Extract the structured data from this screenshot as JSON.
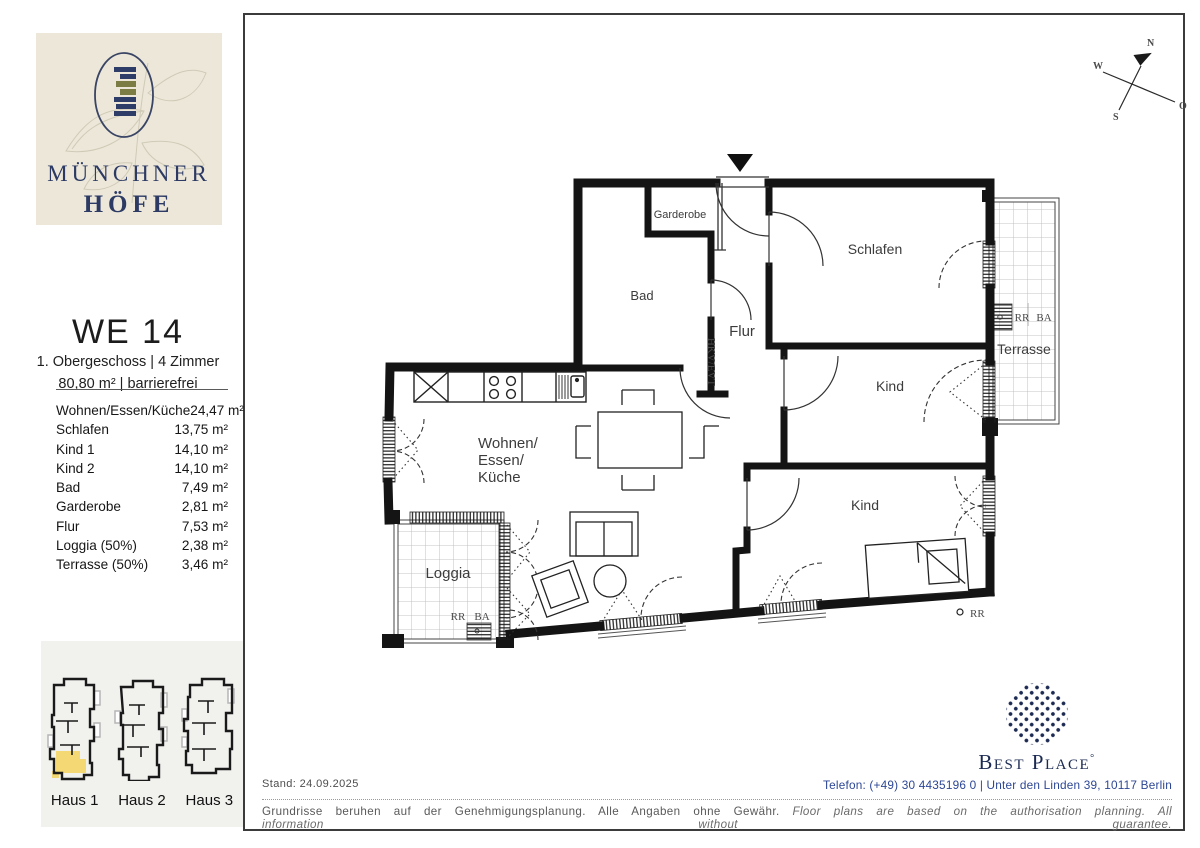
{
  "brand": {
    "line1": "MÜNCHNER",
    "line2": "HÖFE"
  },
  "unit": {
    "title": "WE 14",
    "subtitle1": "1. Obergeschoss | 4 Zimmer",
    "subtitle2": "80,80 m² | barrierefrei"
  },
  "rooms": [
    {
      "label": "Wohnen/Essen/Küche",
      "area": "24,47 m²"
    },
    {
      "label": "Schlafen",
      "area": "13,75 m²"
    },
    {
      "label": "Kind 1",
      "area": "14,10 m²"
    },
    {
      "label": "Kind 2",
      "area": "14,10 m²"
    },
    {
      "label": "Bad",
      "area": "7,49 m²"
    },
    {
      "label": "Garderobe",
      "area": "2,81 m²"
    },
    {
      "label": "Flur",
      "area": "7,53 m²"
    },
    {
      "label": "Loggia (50%)",
      "area": "2,38 m²"
    },
    {
      "label": "Terrasse (50%)",
      "area": "3,46 m²"
    }
  ],
  "houses": [
    {
      "label": "Haus 1",
      "highlighted": "true"
    },
    {
      "label": "Haus 2",
      "highlighted": "false"
    },
    {
      "label": "Haus 3",
      "highlighted": "false"
    }
  ],
  "plan": {
    "labels": {
      "garderobe": "Garderobe",
      "bad": "Bad",
      "flur": "Flur",
      "schlafen": "Schlafen",
      "kind1": "Kind",
      "kind2": "Kind",
      "wohnen_l1": "Wohnen/",
      "wohnen_l2": "Essen/",
      "wohnen_l3": "Küche",
      "loggia": "Loggia",
      "terrasse": "Terrasse",
      "hkv": "HKV/EVT",
      "rr": "RR",
      "ba": "BA",
      "rr_outside": "RR"
    }
  },
  "compass": {
    "n": "N",
    "s": "S",
    "w": "W",
    "o": "O"
  },
  "footer": {
    "stand": "Stand: 24.09.2025",
    "disclaimer_de": "Grundrisse beruhen auf der Genehmigungsplanung. Alle Angaben ohne Gewähr. ",
    "disclaimer_en": "Floor plans are based on the authorisation planning. All information without guarantee.",
    "contact": "Telefon: (+49) 30 4435196 0 | Unter den Linden 39, 10117 Berlin"
  },
  "bestplace": {
    "name": "Best Place",
    "mark": "°"
  },
  "colors": {
    "brand_navy": "#2c3a64",
    "logo_beige": "#ece7d9",
    "highlight_yellow": "#f3d873",
    "wall_black": "#141414",
    "contact_blue": "#2d4796",
    "bestplace_navy": "#1b2a52"
  }
}
